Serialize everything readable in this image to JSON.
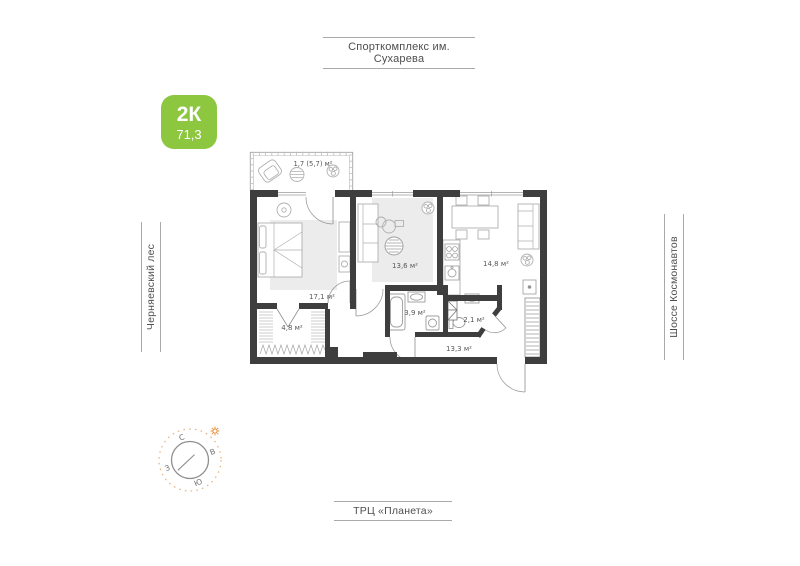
{
  "badge": {
    "rooms_label": "2К",
    "area_label": "71,3"
  },
  "surroundings": {
    "top": "Спорткомплекс им. Сухарева",
    "left": "Черняевский лес",
    "right": "Шоссе Космонавтов",
    "bottom": "ТРЦ «Планета»"
  },
  "plan": {
    "balcony": {
      "area": "1,7 (5,7) м²"
    },
    "rooms": {
      "bedroom": {
        "area": "17,1 м²"
      },
      "living": {
        "area": "13,6 м²"
      },
      "kitchen": {
        "area": "14,8 м²"
      },
      "wardrobe": {
        "area": "4,8 м²"
      },
      "bathroom": {
        "area": "3,9 м²"
      },
      "wc": {
        "area": "2,1 м²"
      },
      "hallway": {
        "area": "13,3 м²"
      }
    }
  },
  "compass": {
    "north": "С",
    "east": "В",
    "south": "Ю",
    "west": "З"
  },
  "colors": {
    "accent_green": "#8dc63f",
    "wall": "#3e3e3e",
    "compass_ring_orange": "#e7b27e",
    "sun_orange": "#e8923f"
  }
}
